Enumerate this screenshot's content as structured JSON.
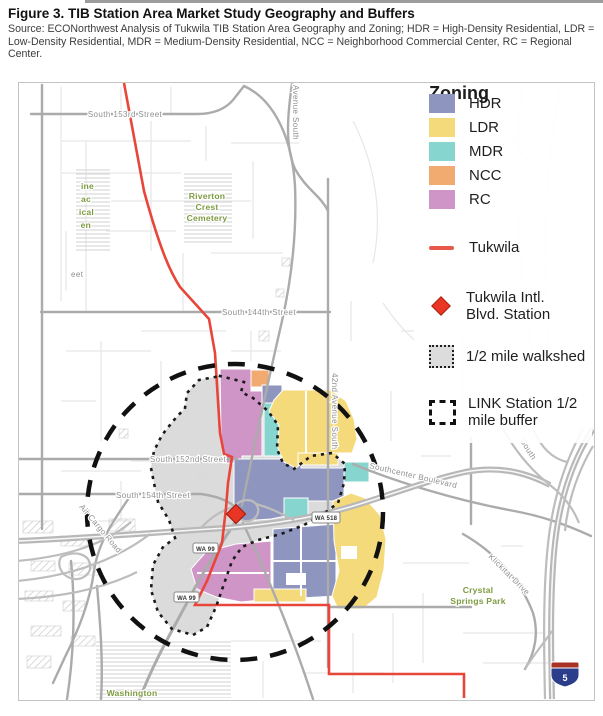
{
  "header": {
    "title": "Figure 3. TIB Station Area Market Study Geography and Buffers",
    "source": "Source: ECONorthwest Analysis of Tukwila TIB Station Area Geography and Zoning; HDR = High-Density Residential, LDR = Low-Density Residential, MDR = Medium-Density Residential, NCC = Neighborhood Commercial Center, RC = Regional Center."
  },
  "legend": {
    "title": "Zoning",
    "zones": [
      {
        "label": "HDR",
        "color": "#8e96bf"
      },
      {
        "label": "LDR",
        "color": "#f5da7c"
      },
      {
        "label": "MDR",
        "color": "#87d5cf"
      },
      {
        "label": "NCC",
        "color": "#f1aa70"
      },
      {
        "label": "RC",
        "color": "#cf95c6"
      }
    ],
    "tukwila_label": "Tukwila",
    "station_label_1": "Tukwila Intl.",
    "station_label_2": "Blvd. Station",
    "walkshed_label": "1/2 mile walkshed",
    "buffer_label_1": "LINK Station 1/2",
    "buffer_label_2": "mile buffer"
  },
  "map": {
    "streets": {
      "s153": "South 153rd Street",
      "s144": "South 144th Street",
      "s152": "South 152nd Street",
      "s154": "South 154th Street",
      "southcenter": "Southcenter Boulevard",
      "air_cargo": "Air Cargo Road",
      "klickitat": "Klickitat Drive",
      "ave_42": "42nd Avenue South",
      "ave_partial": "Avenue South",
      "south_partial": "South",
      "street_partial": "eet"
    },
    "areas": {
      "riverton_1": "Riverton",
      "riverton_2": "Crest",
      "riverton_3": "Cemetery",
      "crystal_1": "Crystal",
      "crystal_2": "Springs Park",
      "washington": "Washington",
      "cut_1": "ine",
      "cut_2": "ac",
      "cut_3": "ical",
      "cut_4": "en"
    },
    "shields": {
      "wa518": "WA 518",
      "wa99": "WA 99",
      "i5": "5"
    }
  },
  "colors": {
    "tukwila_line": "#e8463a",
    "station_marker": "#e93523",
    "walkshed_fill": "#d9d9d9",
    "buffer_stroke": "#111111",
    "major_road": "#ababab",
    "freeway": "#b8b8b8",
    "minor_road": "#e7e7e7",
    "area_label_green": "#7d9b41",
    "street_label_gray": "#8f8f8f"
  }
}
